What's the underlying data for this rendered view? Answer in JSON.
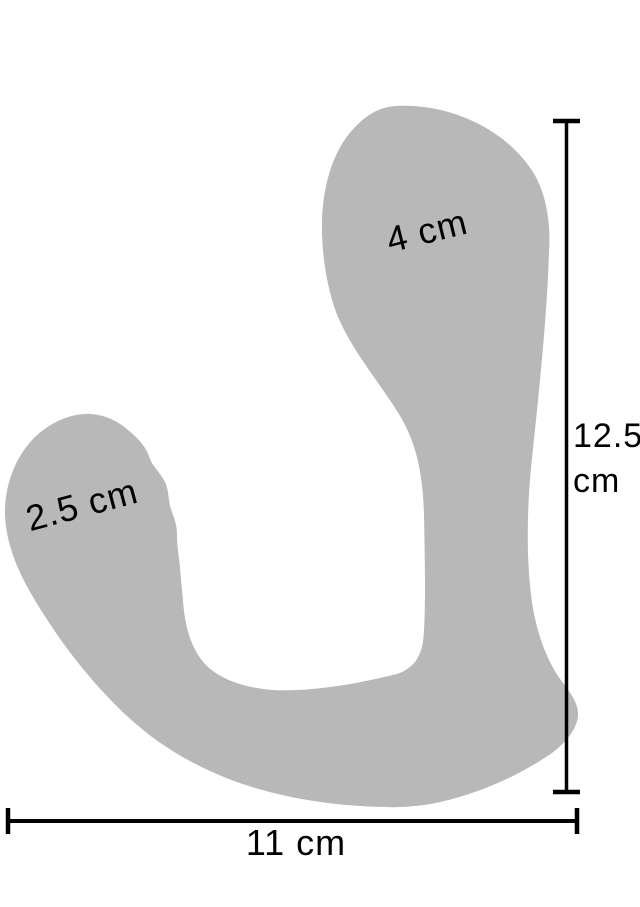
{
  "diagram": {
    "title": "product-dimension-diagram",
    "colors": {
      "background": "#ffffff",
      "silhouette": "#b8b8b8",
      "measurement_line": "#000000",
      "label_text": "#000000"
    },
    "measurements": {
      "upper_bulb_width": "4 cm",
      "lower_bulb_width": "2.5 cm",
      "height_value": "12.5",
      "height_unit": "cm",
      "total_width": "11 cm"
    }
  }
}
